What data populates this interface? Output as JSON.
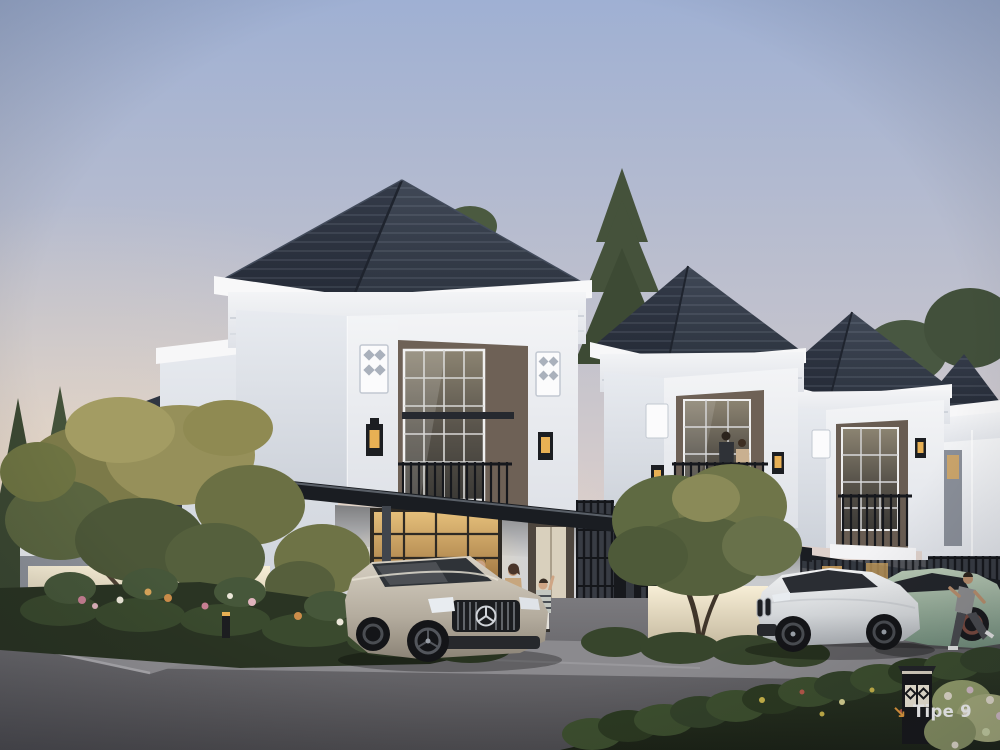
{
  "marker": {
    "arrow_icon": "↘",
    "label": "Tipe 9"
  },
  "palette": {
    "sky_top": "#9fb0d3",
    "sky_horizon": "#eeddca",
    "roof_dark": "#2e3542",
    "wall_white": "#f2f3f5",
    "facade_brown": "#6e6156",
    "panel_gray": "#878c96",
    "window_warm": "#d9a95f",
    "canopy_dark": "#1a1d22",
    "lattice_dark": "#383c44",
    "road_gray": "#6f6e72",
    "apron_gray": "#8b8a8e",
    "foliage_green": "#3c4a33",
    "foliage_gold": "#958c55",
    "hedge_green": "#3d4f2f",
    "car_silver": "#c6bfb2",
    "car_white": "#e8e9ea",
    "car_sage": "#a3b8a6",
    "lantern_glow": "#e8b054",
    "marker_arrow_orange": "#e59b3e",
    "marker_text_white": "#ffffff"
  }
}
